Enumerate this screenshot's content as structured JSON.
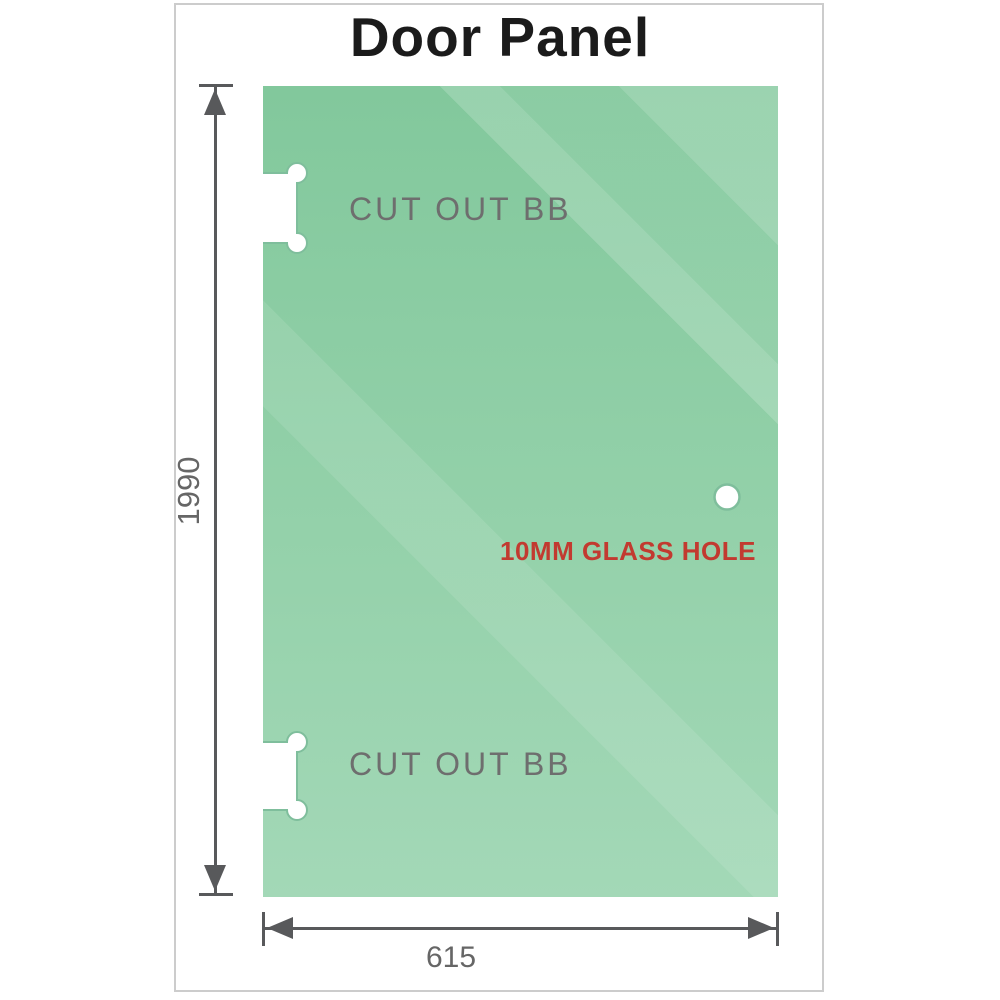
{
  "title": "Door Panel",
  "panel": {
    "cutout_top_label": "CUT OUT BB",
    "cutout_bottom_label": "CUT OUT BB",
    "hole_label": "10MM GLASS HOLE"
  },
  "dimensions": {
    "height_value": "1990",
    "width_value": "615"
  },
  "colors": {
    "title_ink": "#1b1b1b",
    "glass_green_top": "#82c89c",
    "glass_green_mid": "#94d1aa",
    "glass_green_bottom": "#a3d8b7",
    "cutout_stroke_green": "#7fbe9c",
    "label_gray": "#6e6e6e",
    "dim_value_gray": "#666666",
    "dimension_line_gray": "#58595b",
    "hole_label_red": "#c23a30",
    "frame_border_gray": "#cccccc"
  }
}
